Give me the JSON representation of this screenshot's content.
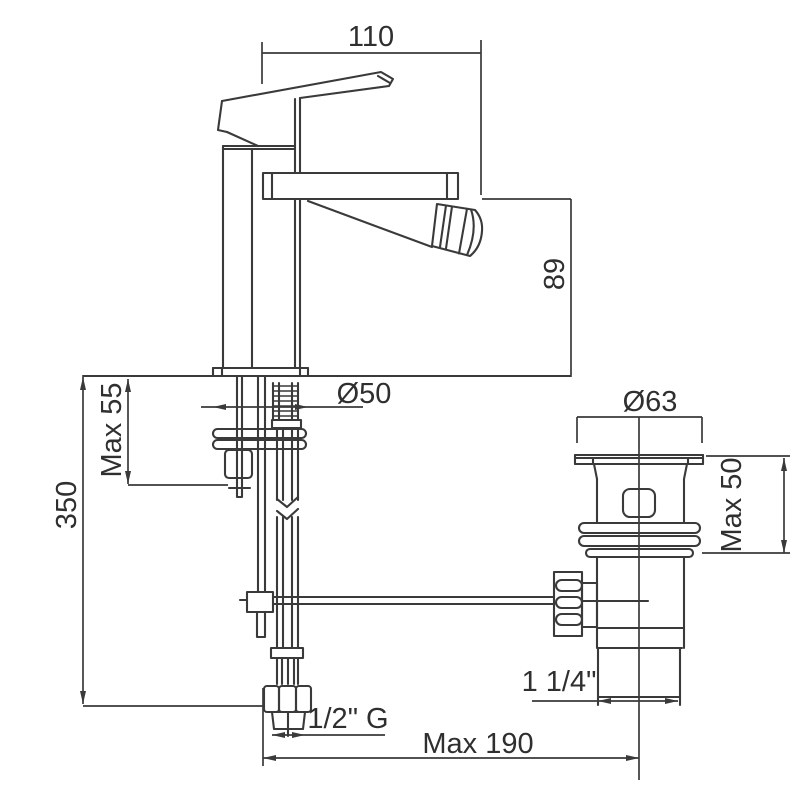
{
  "drawing": {
    "background": "#ffffff",
    "line_color": "#3a3a3a",
    "text_color": "#2f2f2f"
  },
  "dimensions": {
    "spout_reach": "110",
    "spout_height": "89",
    "body_base_diameter": "Ø50",
    "max_mounting_thickness": "Max 55",
    "supply_hose_length": "350",
    "waste_flange_diameter": "Ø63",
    "waste_max_mounting": "Max 50",
    "waste_tailpiece_size": "1 1/4\"",
    "supply_connection_thread": "1/2\" G",
    "max_center_to_waste": "Max 190"
  }
}
